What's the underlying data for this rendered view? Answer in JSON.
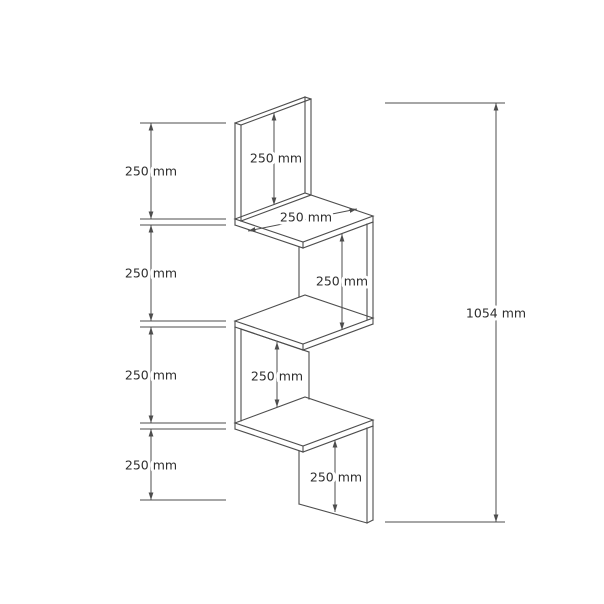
{
  "drawing": {
    "background": "#ffffff",
    "line_color": "#4d4d4d",
    "text_color": "#2e2e2e",
    "dim_labels": {
      "left_chain": [
        "250 mm",
        "250 mm",
        "250 mm",
        "250 mm"
      ],
      "back_panel_height": "250 mm",
      "top_shelf_depth": "250 mm",
      "upper_gap_height": "250 mm",
      "lower_gap_height": "250 mm",
      "bottom_panel_height": "250 mm",
      "overall_height": "1054 mm"
    }
  }
}
